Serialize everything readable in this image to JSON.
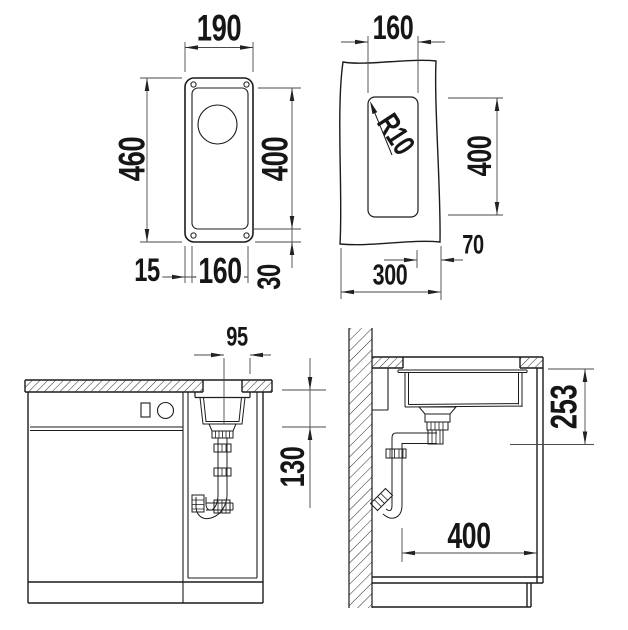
{
  "drawing": {
    "type": "sink installation technical drawing",
    "colors": {
      "line": "#1c1c1c",
      "dimension_line": "#4a4a4a",
      "background": "#ffffff"
    },
    "dims": {
      "top_view": {
        "width": "190",
        "length": "460",
        "bowl_length": "400",
        "edge_offset": "15",
        "bowl_width": "160",
        "end_offset": "30"
      },
      "cutout_view": {
        "width": "160",
        "corner_radius": "R10",
        "length": "400",
        "front_offset": "70",
        "depth": "300"
      },
      "front_view": {
        "drain_center_offset": "95",
        "bowl_depth": "130"
      },
      "side_view": {
        "clearance_height": "253",
        "clearance_depth": "400"
      }
    }
  }
}
